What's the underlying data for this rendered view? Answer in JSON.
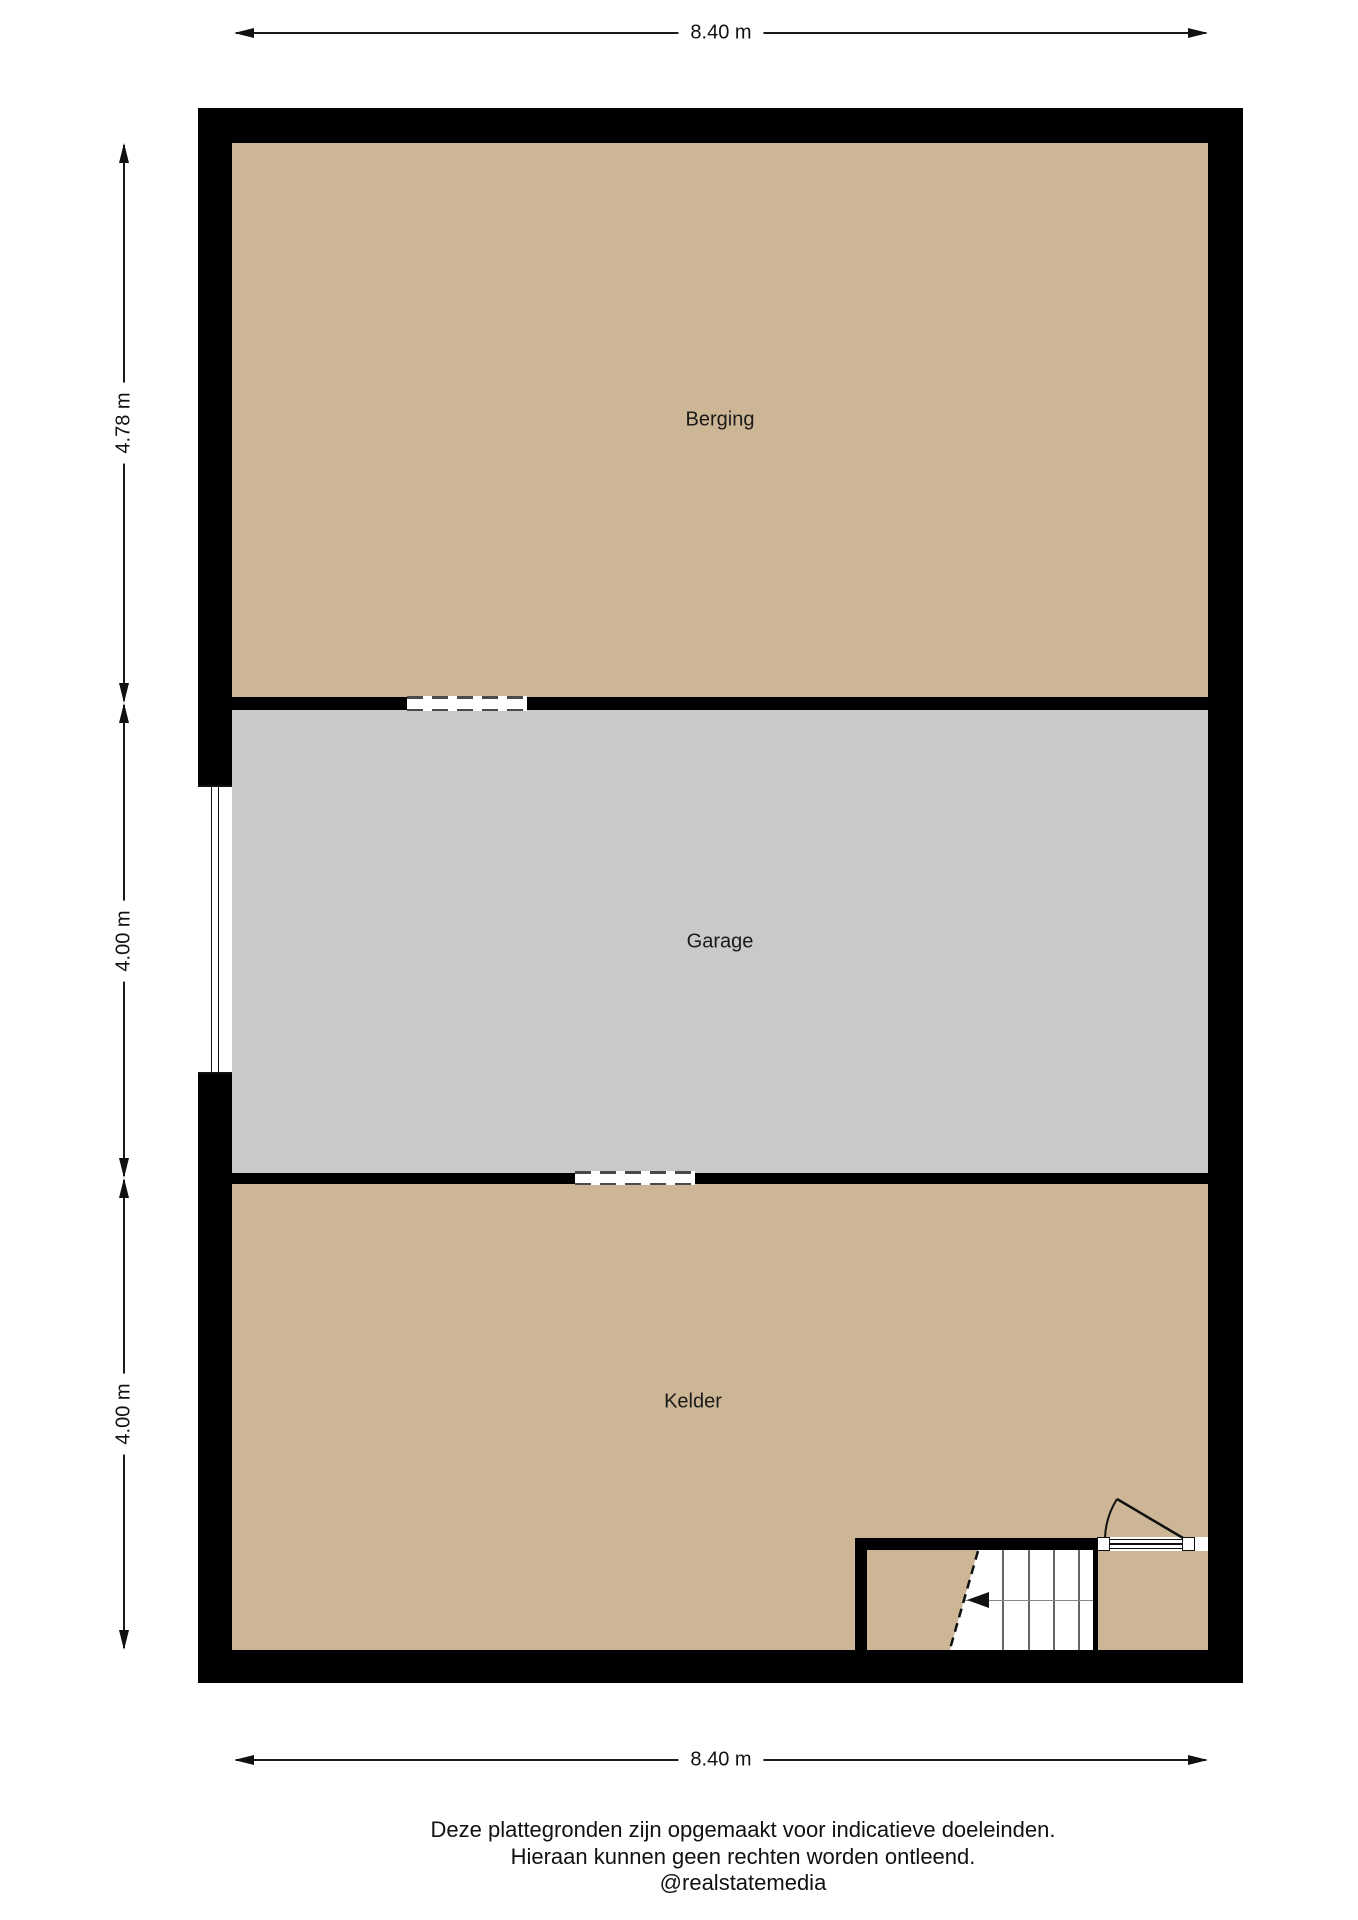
{
  "plan": {
    "rooms": [
      {
        "label": "Berging",
        "floor_color": "#cdb695"
      },
      {
        "label": "Garage",
        "floor_color": "#c9c9c9"
      },
      {
        "label": "Kelder",
        "floor_color": "#cdb695"
      }
    ]
  },
  "dimensions": {
    "top_label": "8.40 m",
    "bottom_label": "8.40 m",
    "left_labels": [
      "4.78 m",
      "4.00 m",
      "4.00 m"
    ]
  },
  "footer": {
    "lines": [
      "Deze plattegronden zijn opgemaakt voor indicatieve doeleinden.",
      "Hieraan kunnen geen rechten worden ontleend.",
      "@realstatemedia"
    ]
  },
  "colors": {
    "wall": "#000000",
    "floor_tan": "#cdb695",
    "floor_gray": "#c9c9c9",
    "dash": "#4a4a4a",
    "background": "#ffffff"
  }
}
